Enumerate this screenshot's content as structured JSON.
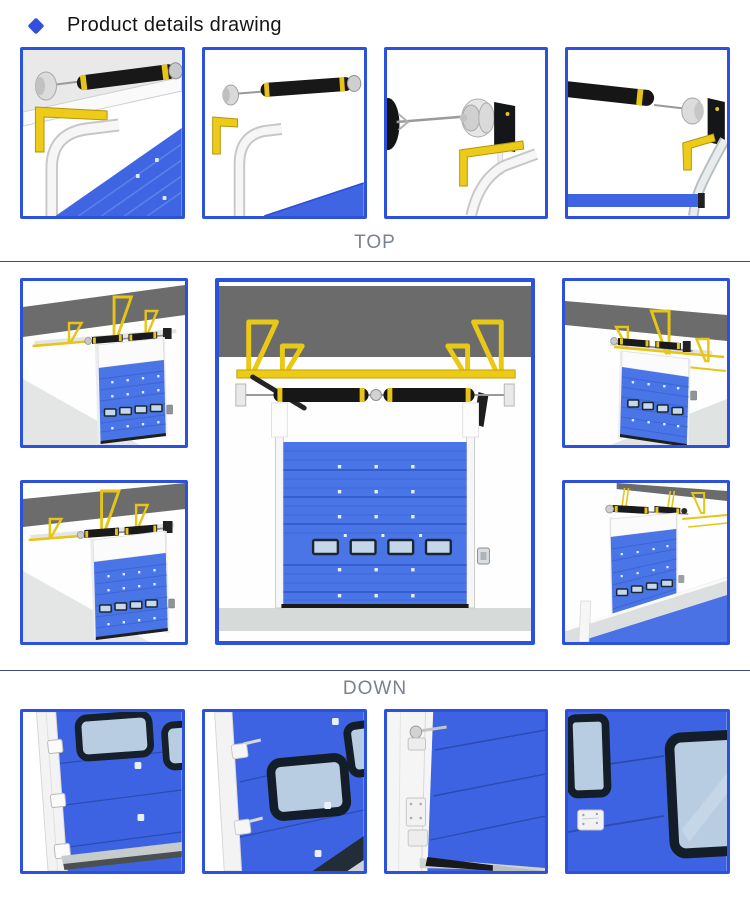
{
  "header": {
    "title": "Product details drawing",
    "bullet_icon": "diamond-icon"
  },
  "sections": {
    "top": {
      "label": "TOP"
    },
    "down": {
      "label": "DOWN"
    }
  },
  "gallery": {
    "top_row_images": [
      "torsion-spring-end-with-angle-bracket-over-door-corner",
      "torsion-spring-with-end-cap-and-curved-track",
      "cable-drum-assembly-with-end-plate-and-bracket",
      "torsion-spring-drum-end-plate-above-door-edge"
    ],
    "middle_images": {
      "left_top": "suspended-door-overhead-track-left-view-a",
      "left_bottom": "suspended-door-overhead-track-left-view-b",
      "center": "sectional-door-front-view-with-torsion-shaft",
      "right_top": "suspended-door-overhead-track-right-view-a",
      "right_bottom": "suspended-door-overhead-track-right-view-b"
    },
    "bottom_row_images": [
      "panel-close-up-windows-and-side-hinges",
      "panel-close-up-center-window",
      "panel-close-up-track-roller-and-hinge-plates",
      "panel-close-up-two-windows-and-hinge-plate"
    ]
  },
  "colors": {
    "accent_border": "#2c52dd",
    "diamond": "#3350dd",
    "title_text": "#151515",
    "label_text": "#7b828c",
    "divider": "#3f4d86",
    "door_blue": "#4a75e6",
    "door_blue_dark": "#3e63e2",
    "ceiling_grey": "#6b6b6b",
    "floor_grey": "#d7dbda",
    "bracket_yellow": "#eac81a",
    "spring_black": "#181818",
    "glass_blue": "#bccfe2",
    "window_frame": "#16202c"
  }
}
